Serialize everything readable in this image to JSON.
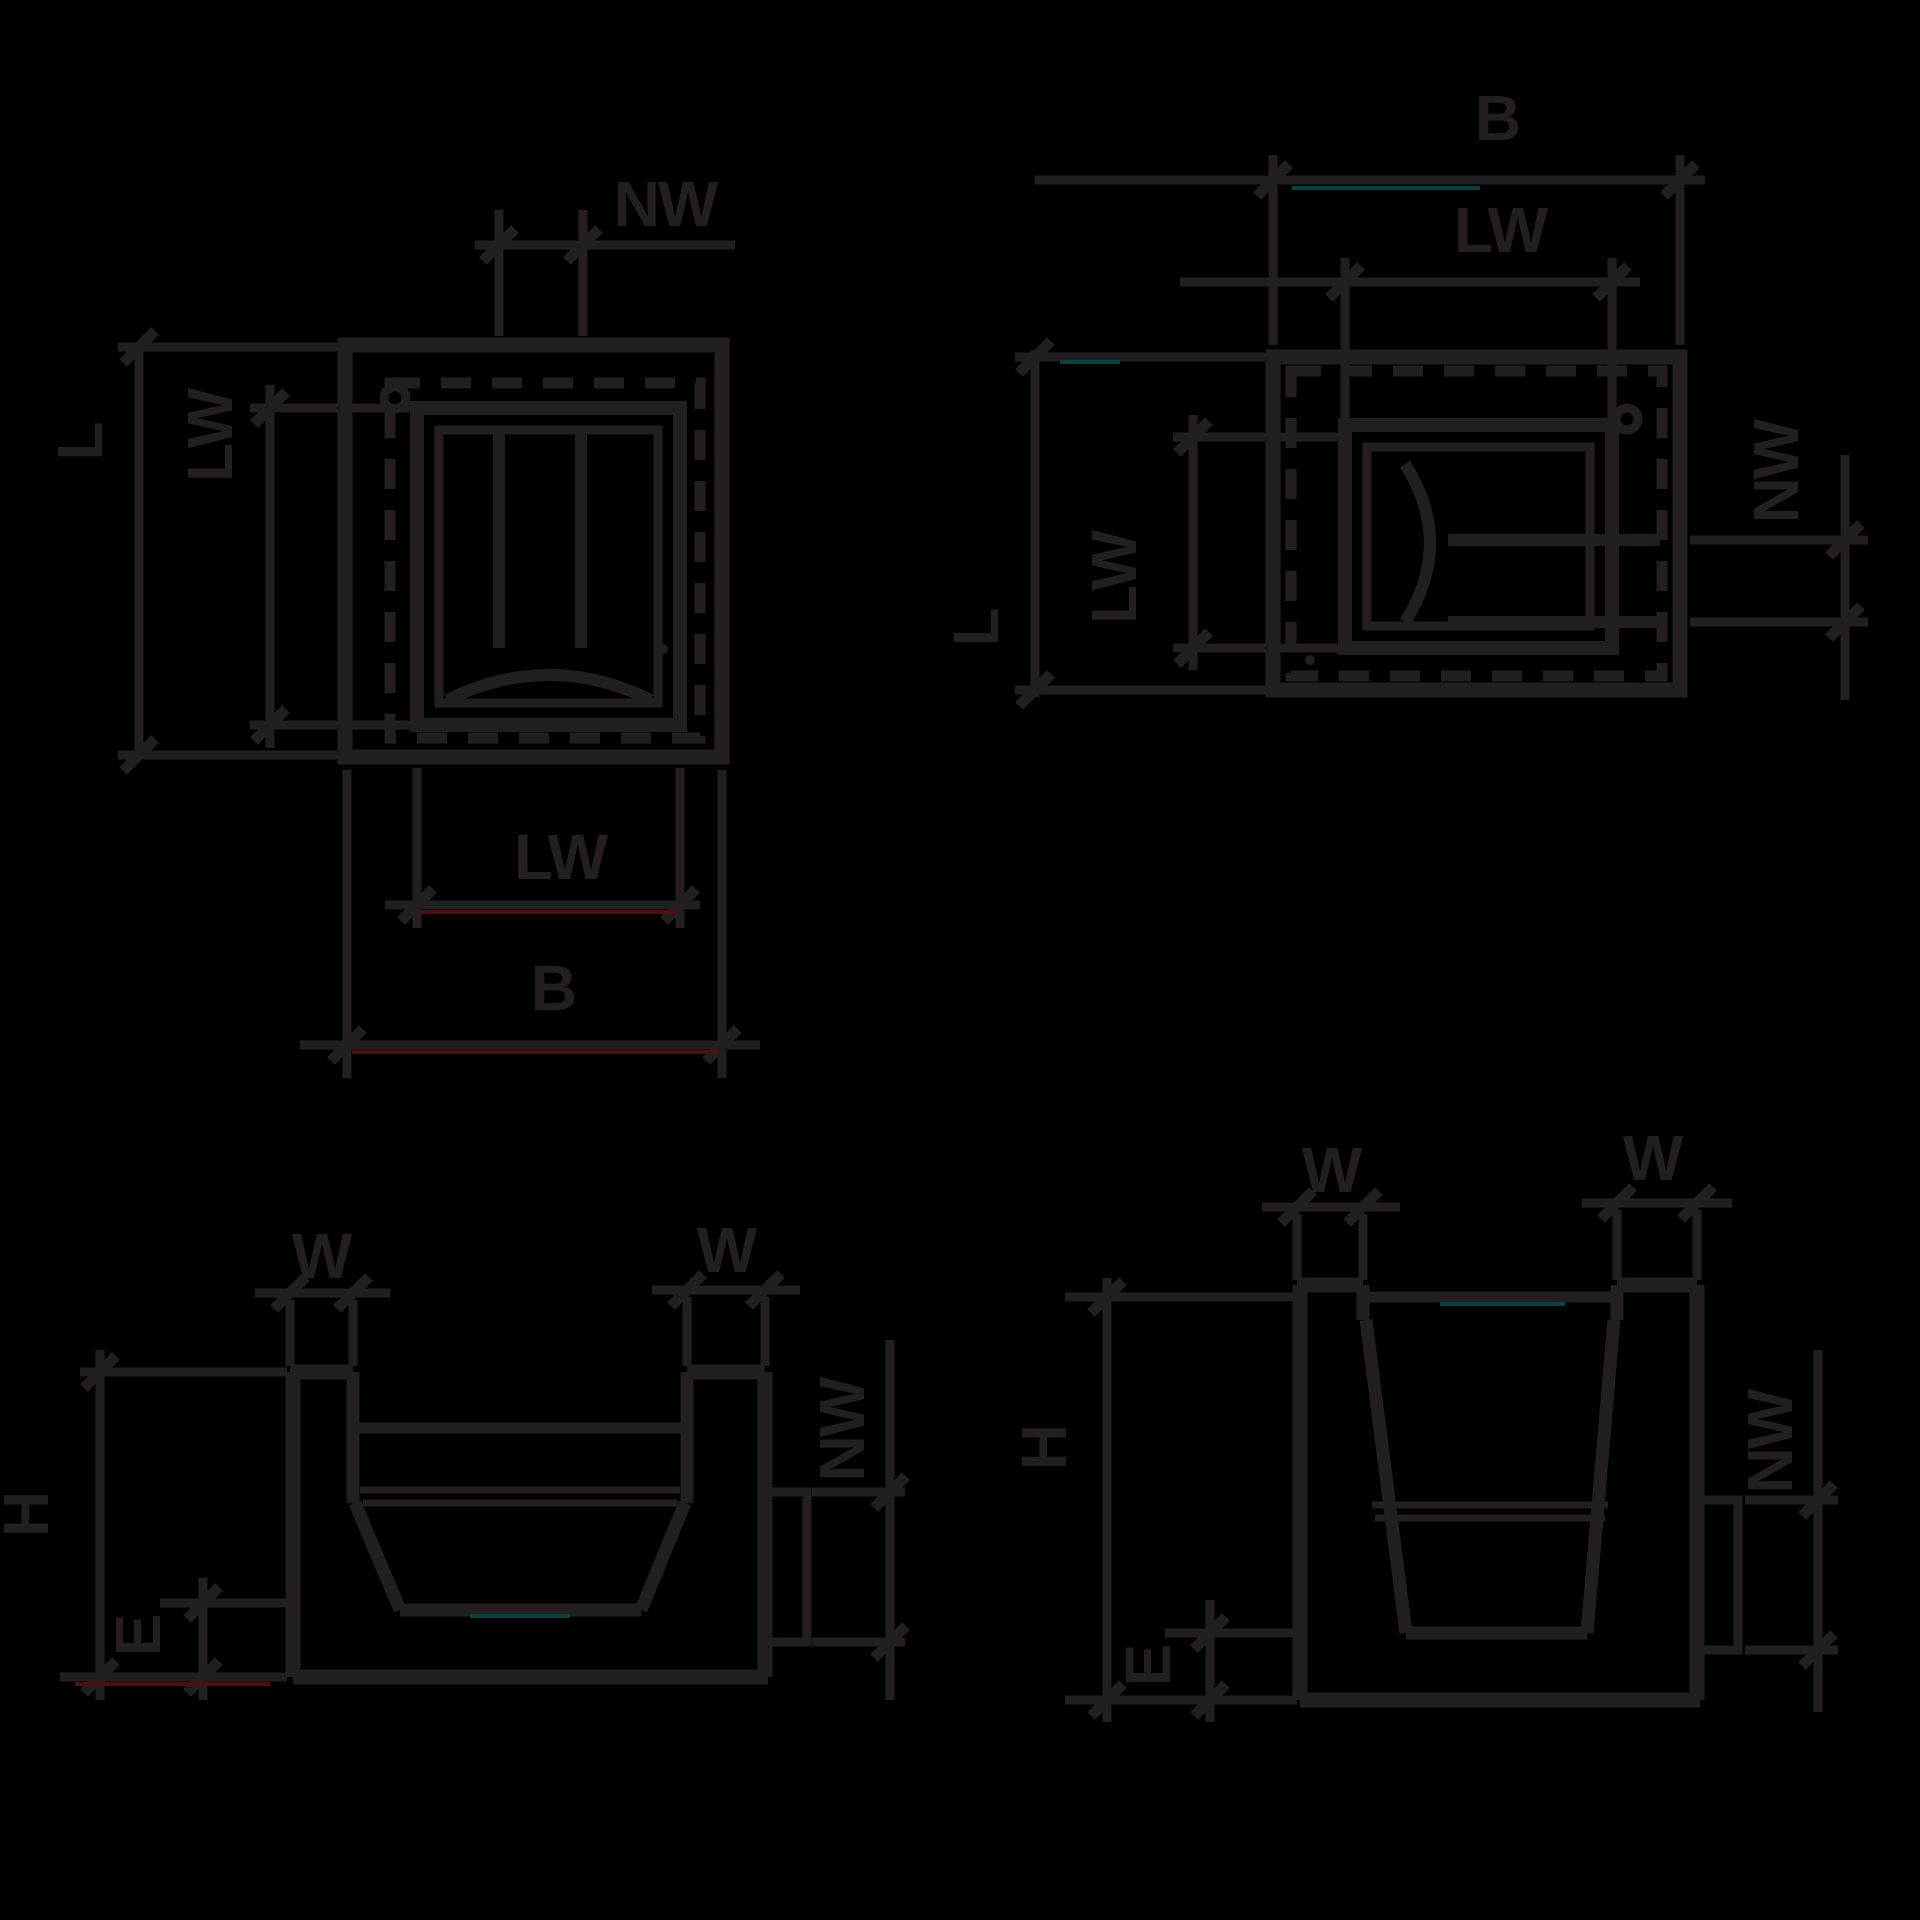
{
  "colors": {
    "background": "#000000",
    "ink": "#231f20",
    "accent_red": "#4a1111",
    "accent_teal": "#0d4040"
  },
  "diagrams": {
    "top_left_plan": {
      "labels": {
        "nw": "NW",
        "l": "L",
        "lw_left": "LW",
        "lw_bottom": "LW",
        "b": "B"
      }
    },
    "top_right_plan": {
      "labels": {
        "b": "B",
        "lw_top": "LW",
        "l": "L",
        "lw_left": "LW",
        "nw": "NW"
      }
    },
    "bottom_left_section": {
      "labels": {
        "w_left": "W",
        "w_right": "W",
        "h": "H",
        "e": "E",
        "nw": "NW"
      }
    },
    "bottom_right_section": {
      "labels": {
        "w_left": "W",
        "w_right": "W",
        "h": "H",
        "e": "E",
        "nw": "NW"
      }
    }
  }
}
